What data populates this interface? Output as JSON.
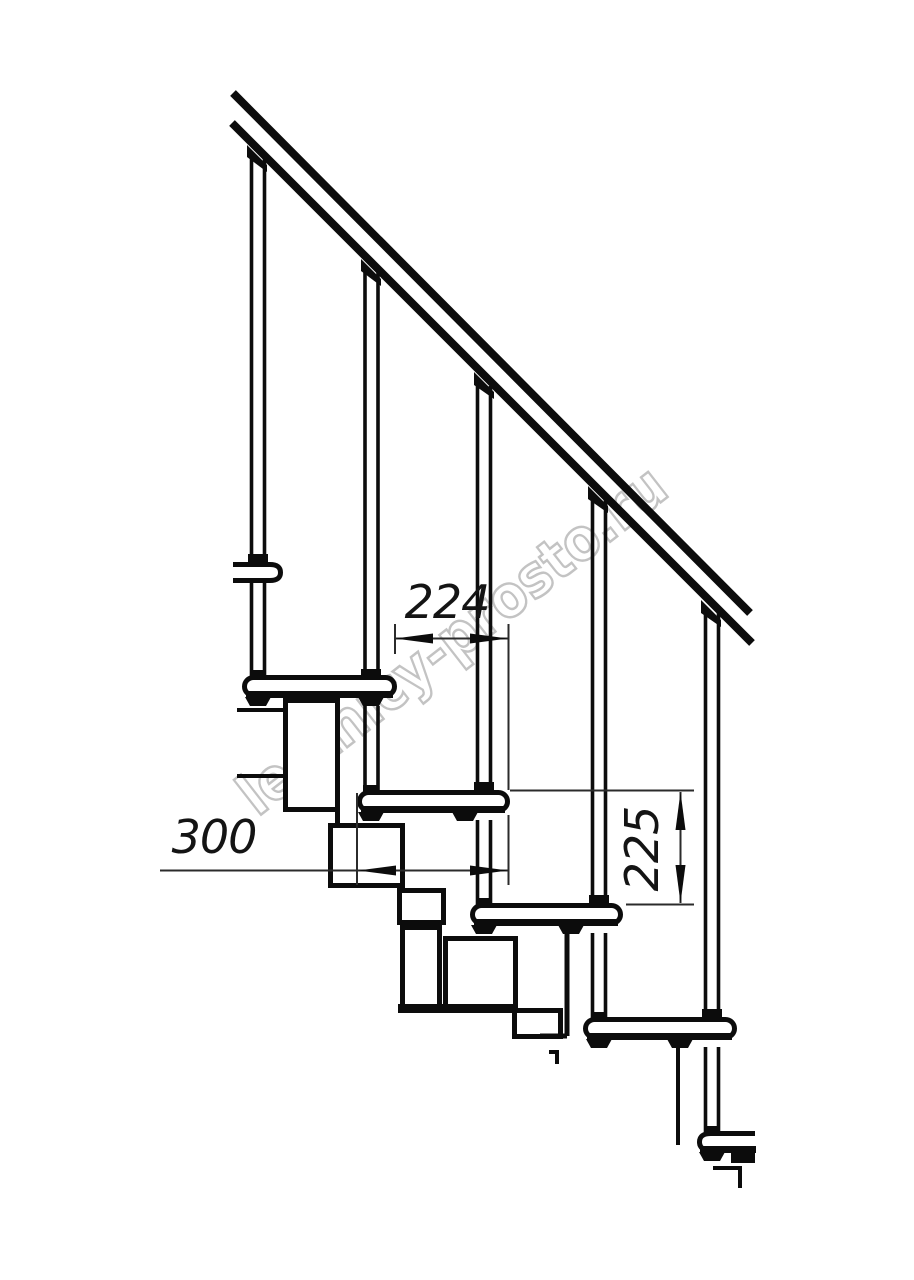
{
  "drawing": {
    "kind": "staircase-fragment-technical-drawing",
    "background": "#ffffff",
    "line_color": "#0c0c0c",
    "dim_color": "#2b2b2b"
  },
  "dimensions": {
    "step_run": "224",
    "tread_length": "300",
    "riser_height": "225"
  },
  "watermark": {
    "text": "lestnicy-prosto.ru",
    "fill": "#ffffff",
    "stroke": "#c0c0c0"
  }
}
